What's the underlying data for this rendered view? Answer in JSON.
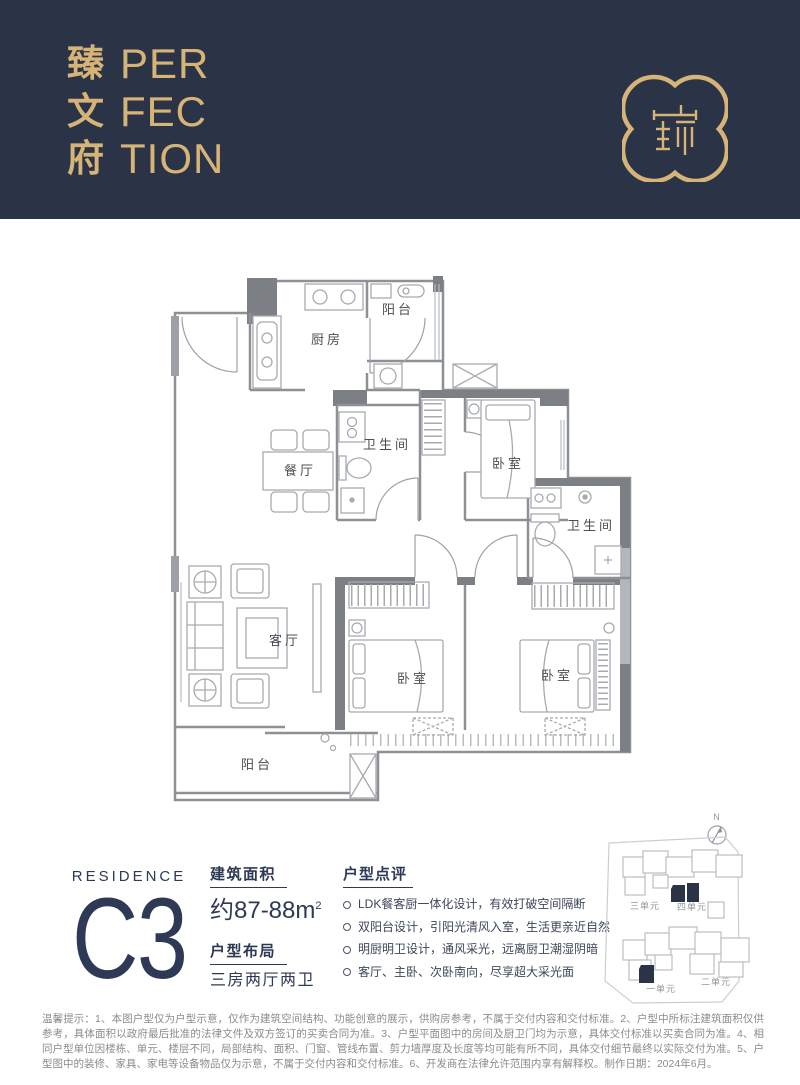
{
  "colors": {
    "header_navy": "#2b3347",
    "gold": "#d6b478",
    "info_navy": "#2e3a55",
    "plan_wall_gray": "#8d9196",
    "plan_furniture_gray": "#a7abaf",
    "disclaimer_gray": "#8b8b8b"
  },
  "header": {
    "brand_cn": [
      "臻",
      "文",
      "府"
    ],
    "brand_en": [
      "PER",
      "FEC",
      "TION"
    ],
    "logo_glyph": "瑧"
  },
  "floorplan": {
    "rooms": [
      "阳台",
      "厨房",
      "卫生间",
      "餐厅",
      "卧室",
      "卫生间",
      "客厅",
      "卧室",
      "卧室",
      "阳台"
    ]
  },
  "info": {
    "residence_label": "RESIDENCE",
    "unit_code": "C3",
    "area": {
      "title": "建筑面积",
      "value": "约87-88m",
      "sup": "2"
    },
    "layout": {
      "title": "户型布局",
      "value": "三房两厅两卫"
    },
    "review": {
      "title": "户型点评",
      "points": [
        "LDK餐客厨一体化设计，有效打破空间隔断",
        "双阳台设计，引阳光清风入室，生活更亲近自然",
        "明厨明卫设计，通风采光，远离厨卫潮湿阴暗",
        "客厅、主卧、次卧南向，尽享超大采光面"
      ]
    }
  },
  "siteplan": {
    "compass_label": "N",
    "unit_labels": [
      "三单元",
      "四单元",
      "一单元",
      "二单元"
    ]
  },
  "disclaimer": "温馨提示：1、本图户型仅为户型示意，仅作为建筑空间结构、功能创意的展示，供购房参考，不属于交付内容和交付标准。2、户型中所标注建筑面积仅供参考，具体面积以政府最后批准的法律文件及双方签订的买卖合同为准。3、户型平面图中的房间及厨卫门均为示意，具体交付标准以买卖合同为准。4、相同户型单位因楼栋、单元、楼层不同，局部结构、面积、门窗、管线布置、剪力墙厚度及长度等均可能有所不同，具体交付细节最终以实际交付为准。5、户型图中的装修、家具、家电等设备物品仅为示意，不属于交付内容和交付标准。6、开发商在法律允许范围内享有解释权。制作日期：2024年6月。"
}
